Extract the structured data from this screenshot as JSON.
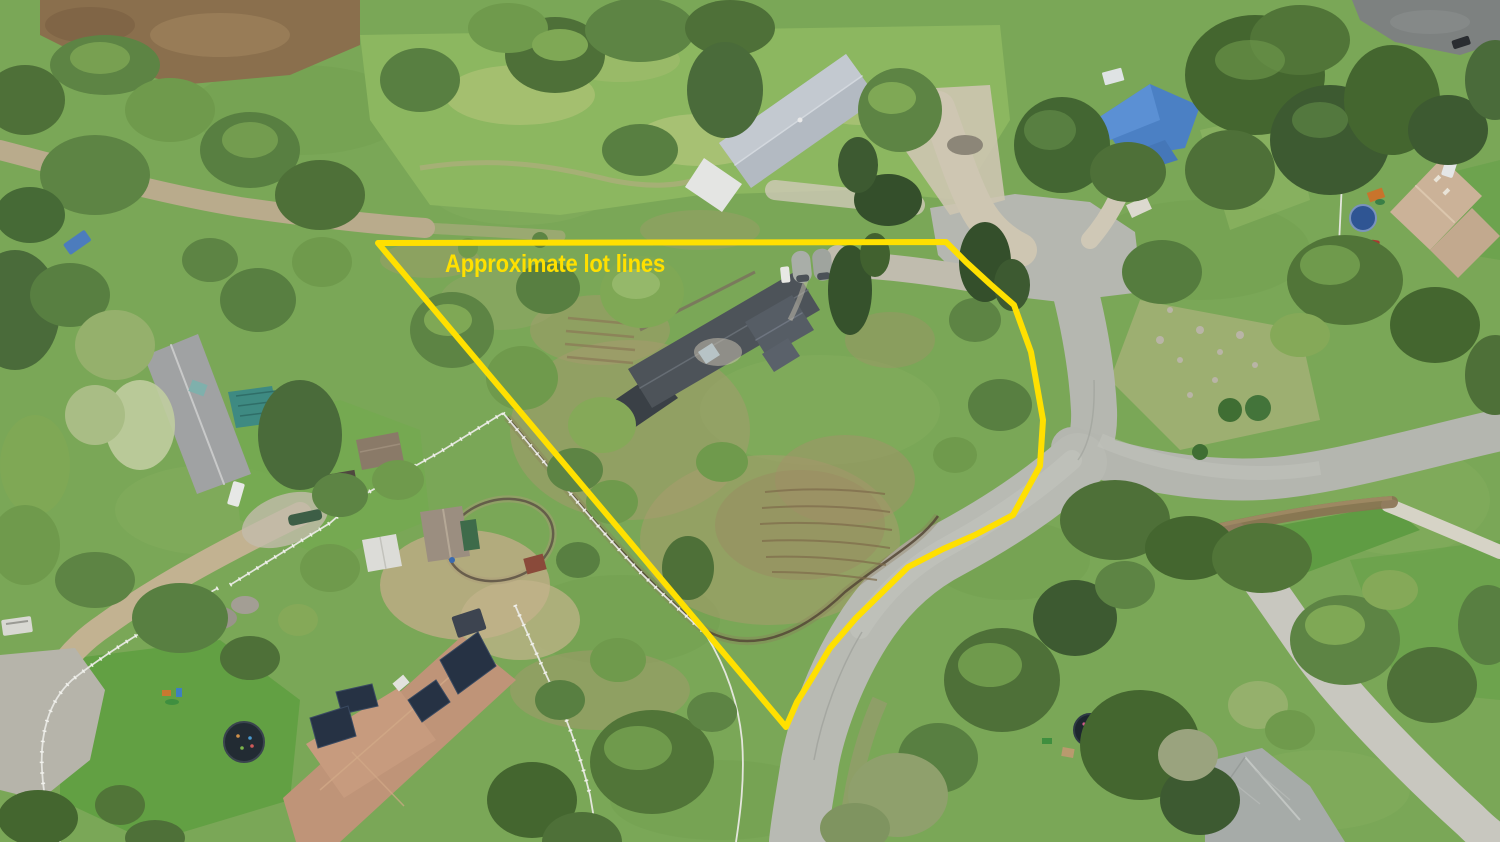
{
  "annotation": {
    "label": "Approximate lot lines",
    "color": "#ffe000",
    "line_width": 6,
    "lot_line_points": "378,243 946,242 966,262 990,284 1014,305 1031,352 1043,420 1040,466 1013,515 975,535 943,549 908,567 856,618 830,648 812,678 797,702 786,727"
  },
  "scene": {
    "type": "aerial-drone-photo",
    "setting": "rural residential neighborhood with oak trees, meadows and winding gray roads",
    "features": [
      {
        "name": "outlined-lot",
        "description": "grassy parcel outlined in yellow with single-story dark-roof house and quonset garages"
      },
      {
        "name": "north-neighbor-house",
        "description": "long house with light blue-gray roof and white porch"
      },
      {
        "name": "blue-roof-house",
        "description": "house with bright blue roof at upper right"
      },
      {
        "name": "east-neighbor-house",
        "description": "tan-roof house with blue trampoline, play set and parked cars"
      },
      {
        "name": "west-neighbor-house",
        "description": "gray-roof house with teal carport, white car and horse corral with barn"
      },
      {
        "name": "solar-panel-house",
        "description": "tan-roof house with dark rooftop solar panels and black trampoline at lower left"
      },
      {
        "name": "southeast-house",
        "description": "gray shingle-roof house at bottom edge"
      },
      {
        "name": "cul-de-sac",
        "description": "paved turnaround and driveways at top of lot"
      }
    ]
  },
  "palette": {
    "grass": "#7aa757",
    "meadow": "#8cb760",
    "dry_grass": "#aeb37c",
    "dirt": "#b3a176",
    "asphalt": "#b5b7b0",
    "gravel": "#cdc5b1",
    "tree_dark": "#3d5a31",
    "tree_mid": "#5d8444",
    "tree_light": "#7fa855",
    "annotation_yellow": "#ffe000"
  }
}
